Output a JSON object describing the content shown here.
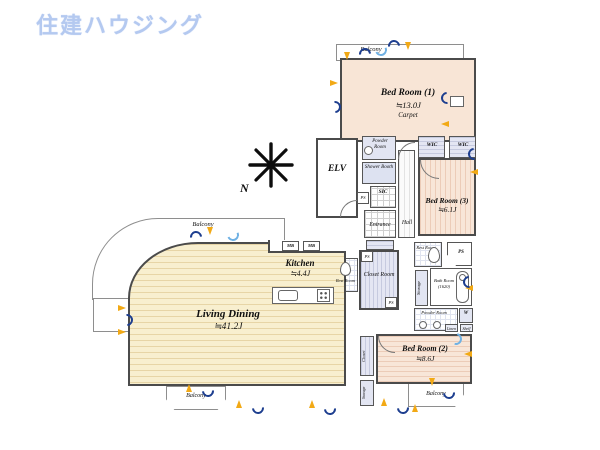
{
  "logo": {
    "text": "住建ハウジング",
    "color": "#b4c9f0"
  },
  "compass": {
    "north_label": "N"
  },
  "balconies": {
    "top": "Balcony",
    "left": "Balcony",
    "bottom_left": "Balcony",
    "bottom_right": "Balcony"
  },
  "rooms": {
    "bed_room_1": {
      "name": "Bed Room (1)",
      "area": "≒13.0J",
      "note": "Carpet"
    },
    "bed_room_2": {
      "name": "Bed Room (2)",
      "area": "≒8.6J"
    },
    "bed_room_3": {
      "name": "Bed Room (3)",
      "area": "≒6.1J"
    },
    "living_dining": {
      "name": "Living Dining",
      "area": "≒41.2J"
    },
    "kitchen": {
      "name": "Kitchen",
      "area": "≒4.4J"
    },
    "elevator": {
      "name": "ELV"
    },
    "entrance": {
      "name": "Entrance"
    },
    "hall": {
      "name": "Hall"
    },
    "sic": {
      "name": "SIC"
    },
    "shower_booth": {
      "name": "Shower Booth"
    },
    "powder_room_upper": {
      "name": "Powder Room"
    },
    "powder_room_lower": {
      "name": "Powder Room"
    },
    "rest_room_upper": {
      "name": "Rest Room"
    },
    "rest_room_center": {
      "name": "Rest Room"
    },
    "closet_room": {
      "name": "Closet Room"
    },
    "bath_room": {
      "name": "Bath Room",
      "size": "(1620)"
    },
    "wic_left": {
      "name": "WIC"
    },
    "wic_right": {
      "name": "WIC"
    },
    "storage_mid": {
      "name": "Storage"
    },
    "storage_bottom": {
      "name": "Storage"
    },
    "closet_bottom": {
      "name": "Closet"
    },
    "washer": {
      "name": "W"
    },
    "linen": {
      "name": "Linen"
    },
    "shelf": {
      "name": "Shelf"
    },
    "mb": {
      "name": "MB"
    },
    "ps": {
      "name": "PS"
    }
  },
  "colors": {
    "wall": "#4b4b4b",
    "carpet_fill": "#f8e5d6",
    "wood_fill": "#f8efcf",
    "closet_fill": "#e4e6f3",
    "marker_yellow": "#f2a915",
    "marker_navy": "#1d3e8f",
    "marker_lightblue": "#6fb1e4"
  }
}
